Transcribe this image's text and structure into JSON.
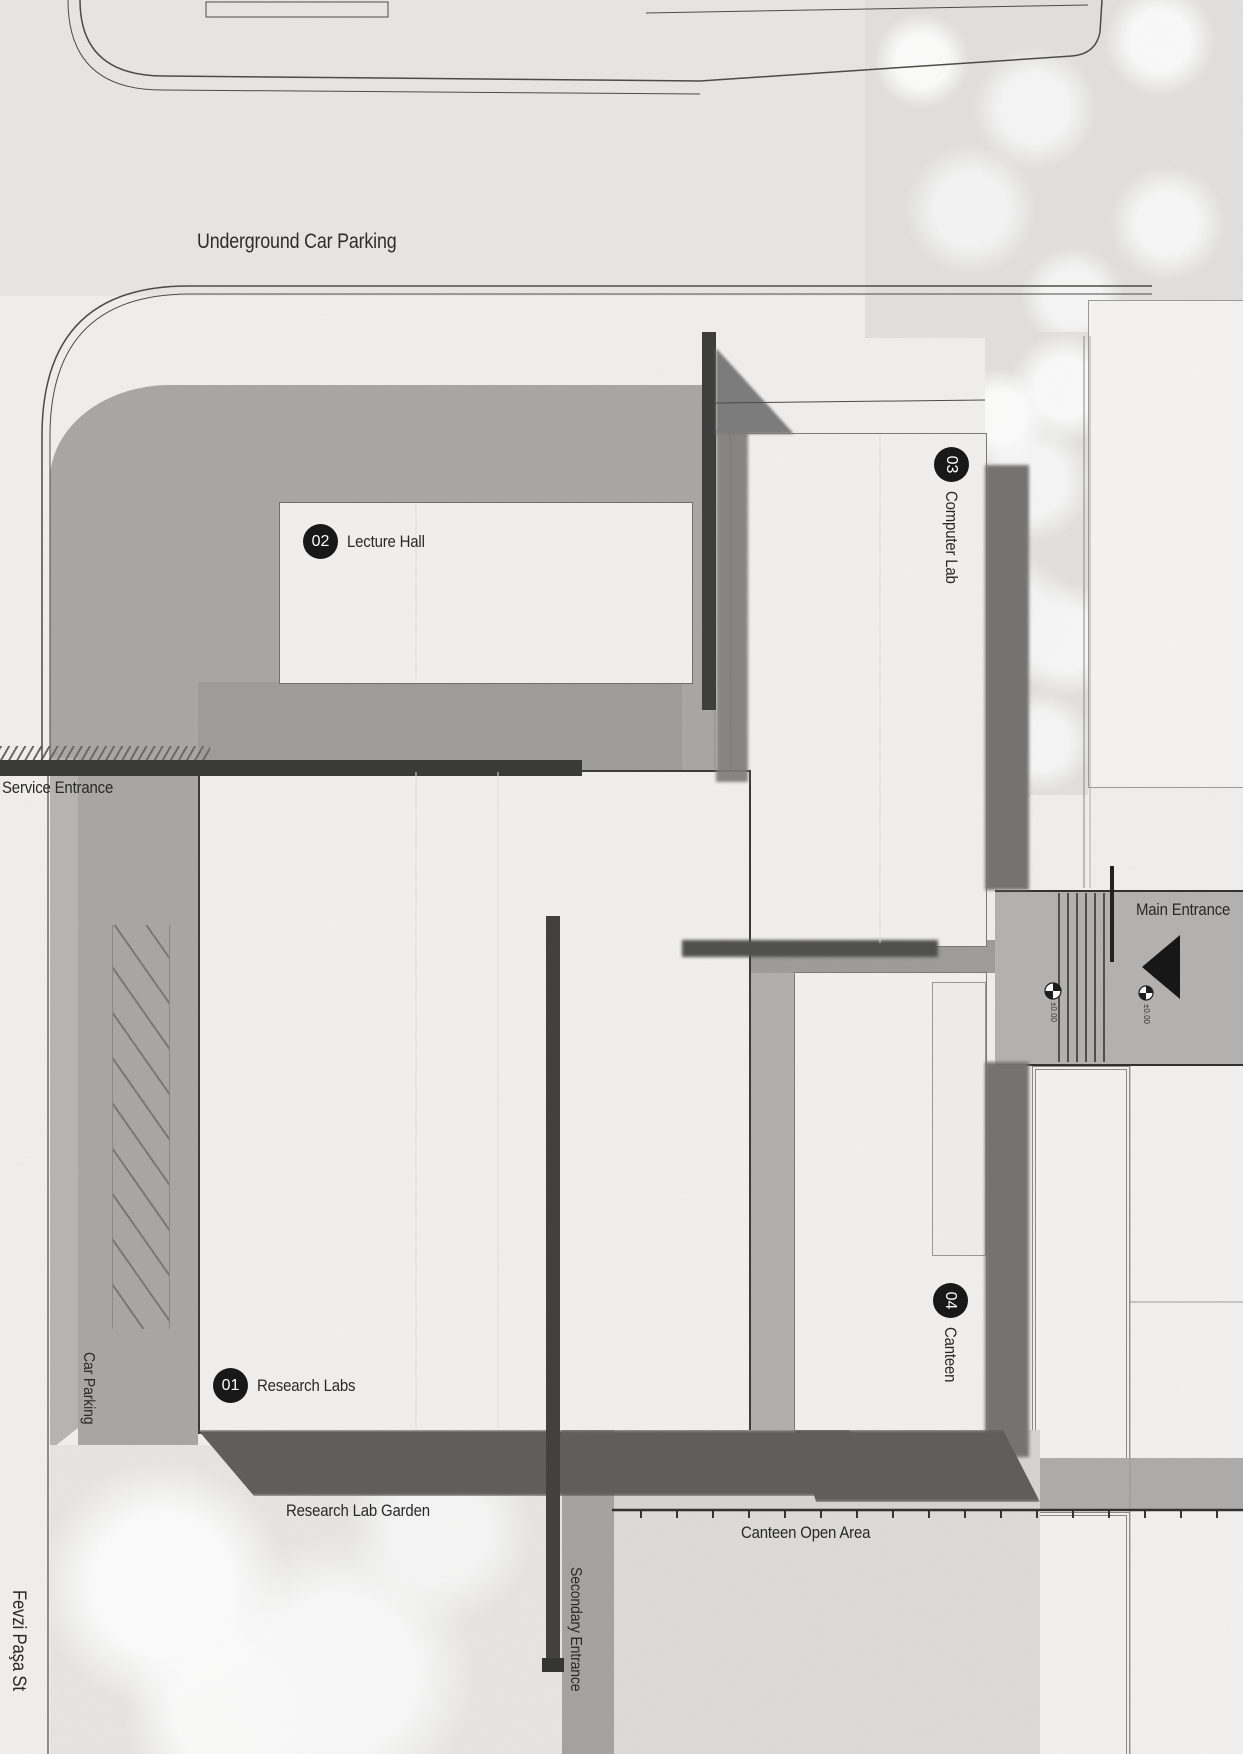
{
  "plan": {
    "street": "Fevzi Paşa St",
    "areas": {
      "underground_car_parking": "Underground Car Parking",
      "car_parking": "Car Parking",
      "research_lab_garden": "Research Lab Garden",
      "canteen_open_area": "Canteen Open Area"
    },
    "entrances": {
      "service": "Service Entrance",
      "main": "Main Entrance",
      "secondary": "Secondary Entrance"
    },
    "buildings": [
      {
        "number": "01",
        "name": "Research Labs"
      },
      {
        "number": "02",
        "name": "Lecture Hall"
      },
      {
        "number": "03",
        "name": "Computer Lab"
      },
      {
        "number": "04",
        "name": "Canteen"
      }
    ],
    "level_marker": "±0.00",
    "colors": {
      "badge": "#151515",
      "building_fill": "#f3f2f0",
      "plaza": "#a9a8a7",
      "shadow": "#6f6f6e",
      "text": "#262626"
    }
  }
}
